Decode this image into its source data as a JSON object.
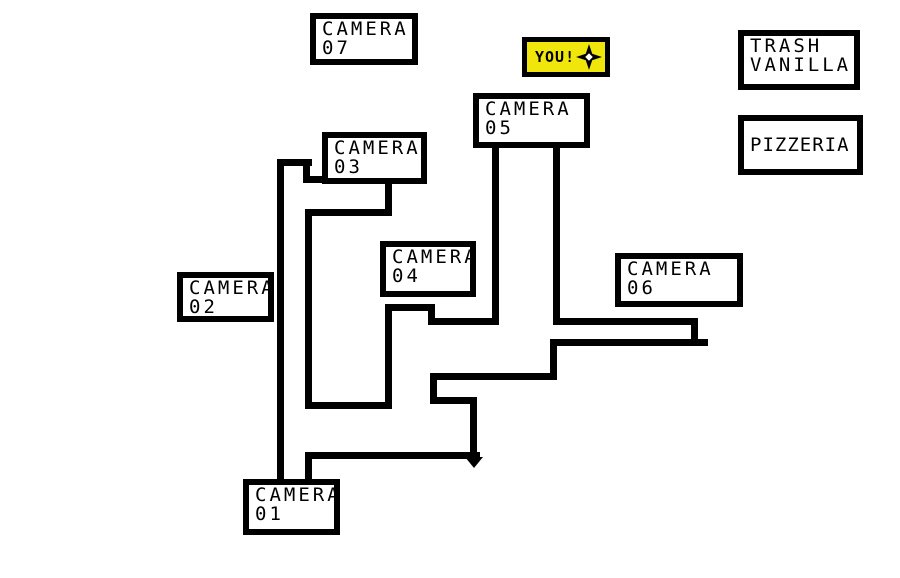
{
  "title": "Pizzeria camera map",
  "colors": {
    "background": "#ffffff",
    "ink": "#000000",
    "you_fill": "#f0e60c"
  },
  "labels": {
    "camera07": {
      "line1": "CAMERA",
      "line2": "07",
      "box": [
        310,
        13,
        108,
        52
      ]
    },
    "camera05": {
      "line1": "CAMERA",
      "line2": "05",
      "box": [
        473,
        93,
        117,
        55
      ]
    },
    "camera03": {
      "line1": "CAMERA",
      "line2": "03",
      "box": [
        322,
        132,
        105,
        52
      ]
    },
    "camera04": {
      "line1": "CAMERA",
      "line2": "04",
      "box": [
        380,
        241,
        96,
        56
      ]
    },
    "camera02": {
      "line1": "CAMERA",
      "line2": "02",
      "box": [
        177,
        272,
        97,
        50
      ]
    },
    "camera06": {
      "line1": "CAMERA",
      "line2": "06",
      "box": [
        615,
        253,
        128,
        54
      ]
    },
    "camera01": {
      "line1": "CAMERA",
      "line2": "01",
      "box": [
        243,
        479,
        97,
        56
      ]
    },
    "trash_vanilla": {
      "line1": "TRASH",
      "line2": "VANILLA",
      "box": [
        738,
        30,
        122,
        60
      ]
    },
    "pizzeria": {
      "line1": "PIZZERIA",
      "box": [
        738,
        115,
        125,
        60
      ]
    },
    "you": {
      "text": "YOU!",
      "box": [
        522,
        37,
        88,
        40
      ]
    }
  },
  "icons": {
    "you_star": "four-pointed-star-icon"
  },
  "map_walls": [
    {
      "x": 277,
      "y": 159,
      "w": 7,
      "h": 320
    },
    {
      "x": 277,
      "y": 159,
      "w": 35,
      "h": 7
    },
    {
      "x": 303,
      "y": 159,
      "w": 7,
      "h": 24
    },
    {
      "x": 303,
      "y": 176,
      "w": 24,
      "h": 7
    },
    {
      "x": 385,
      "y": 182,
      "w": 7,
      "h": 33
    },
    {
      "x": 305,
      "y": 209,
      "w": 87,
      "h": 7
    },
    {
      "x": 305,
      "y": 209,
      "w": 7,
      "h": 200
    },
    {
      "x": 305,
      "y": 402,
      "w": 86,
      "h": 7
    },
    {
      "x": 385,
      "y": 304,
      "w": 7,
      "h": 105
    },
    {
      "x": 385,
      "y": 304,
      "w": 50,
      "h": 7
    },
    {
      "x": 428,
      "y": 304,
      "w": 7,
      "h": 21
    },
    {
      "x": 428,
      "y": 318,
      "w": 71,
      "h": 7
    },
    {
      "x": 492,
      "y": 146,
      "w": 7,
      "h": 179
    },
    {
      "x": 553,
      "y": 146,
      "w": 7,
      "h": 179
    },
    {
      "x": 553,
      "y": 318,
      "w": 145,
      "h": 7
    },
    {
      "x": 691,
      "y": 318,
      "w": 7,
      "h": 28
    },
    {
      "x": 550,
      "y": 339,
      "w": 158,
      "h": 7
    },
    {
      "x": 550,
      "y": 339,
      "w": 7,
      "h": 41
    },
    {
      "x": 430,
      "y": 373,
      "w": 127,
      "h": 7
    },
    {
      "x": 430,
      "y": 373,
      "w": 7,
      "h": 31
    },
    {
      "x": 430,
      "y": 397,
      "w": 47,
      "h": 7
    },
    {
      "x": 470,
      "y": 397,
      "w": 7,
      "h": 57
    },
    {
      "x": 305,
      "y": 452,
      "w": 175,
      "h": 7
    },
    {
      "x": 305,
      "y": 452,
      "w": 7,
      "h": 27
    }
  ],
  "arrow_tip": {
    "x": 465,
    "y": 457
  }
}
